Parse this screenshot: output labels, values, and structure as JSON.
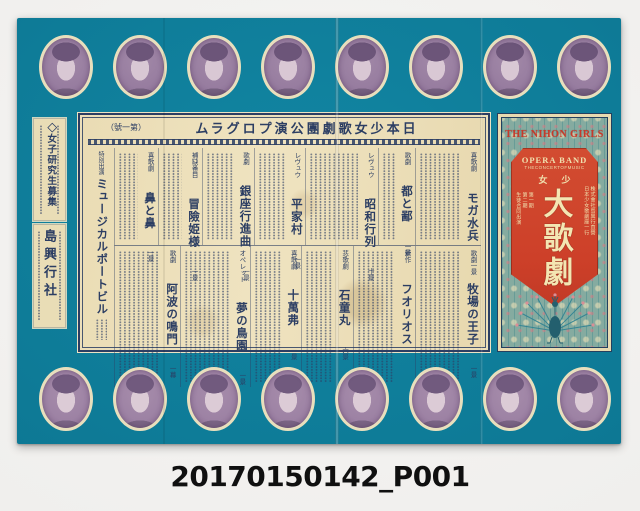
{
  "catalog_id": "20170150142_P001",
  "poster": {
    "colors": {
      "teal": "#0d7894",
      "paper_cream": "#ecdfba",
      "navy_ink": "#2c3e63",
      "panel_red": "#cd4029",
      "red_panel_text": "#f0e0ae",
      "portrait_purple": "#94799d"
    },
    "portraits": {
      "top_count": 8,
      "bottom_count": 8
    },
    "left_notices": {
      "recruit": {
        "title": "◇女子研究生募集"
      },
      "agency": {
        "title": "島興行社"
      }
    },
    "program": {
      "header": {
        "text": "日本少女歌劇團公演プログラム",
        "display": "ムラグロプ演公團劇歌女少本日",
        "issue_text": "第一號",
        "issue_display": "（號一第）"
      },
      "special": {
        "label": "特別出演",
        "title": "ミュージカルポートビル"
      },
      "row1": [
        {
          "genre": "喜歌劇",
          "title": "モガ水兵",
          "scenes": "一景"
        },
        {
          "genre": "歌劇",
          "title": "都と鄙",
          "scenes": "一景"
        },
        {
          "genre": "レヴュウ",
          "title": "昭和行列",
          "scenes": "十景"
        },
        {
          "genre": "レヴュウ",
          "title": "平家村",
          "scenes": "一景"
        },
        {
          "genre": "歌劇",
          "title": "銀座行進曲",
          "scenes": "一景"
        },
        {
          "genre": "補缺番目",
          "title": "冒險姫様",
          "scenes": "一景"
        },
        {
          "genre": "喜歌劇",
          "title": "鼻と鼻",
          "scenes": "一景"
        }
      ],
      "row2": [
        {
          "genre": "歌劇",
          "title": "牧場の王子",
          "scenes": "一景"
        },
        {
          "genre": "新作",
          "title": "フオリオス",
          "scenes": ""
        },
        {
          "genre": "悲歌劇",
          "title": "石童丸",
          "scenes": "六景"
        },
        {
          "genre": "喜歌劇",
          "title": "十萬弗",
          "scenes": "一景"
        },
        {
          "genre": "オペレット",
          "title": "夢の鳥園",
          "scenes": "一景"
        },
        {
          "genre": "歌劇",
          "title": "阿波の鳴門",
          "scenes": "一幕"
        }
      ]
    },
    "right_panel": {
      "title": "THE NIHON GIRLS",
      "shield": {
        "band": "OPERA BAND",
        "band_subtitle": "THECONCERTOFMUSIC",
        "shoujo_text": "少女",
        "shoujo_display": "女少",
        "main_title": "大歌劇",
        "right_text_1": "株式會社島興行直營",
        "right_text_2": "日本少女歌劇座一行",
        "left_text_1": "第一期",
        "left_text_2": "第二期",
        "left_text_3": "生徒合同出演"
      }
    }
  }
}
